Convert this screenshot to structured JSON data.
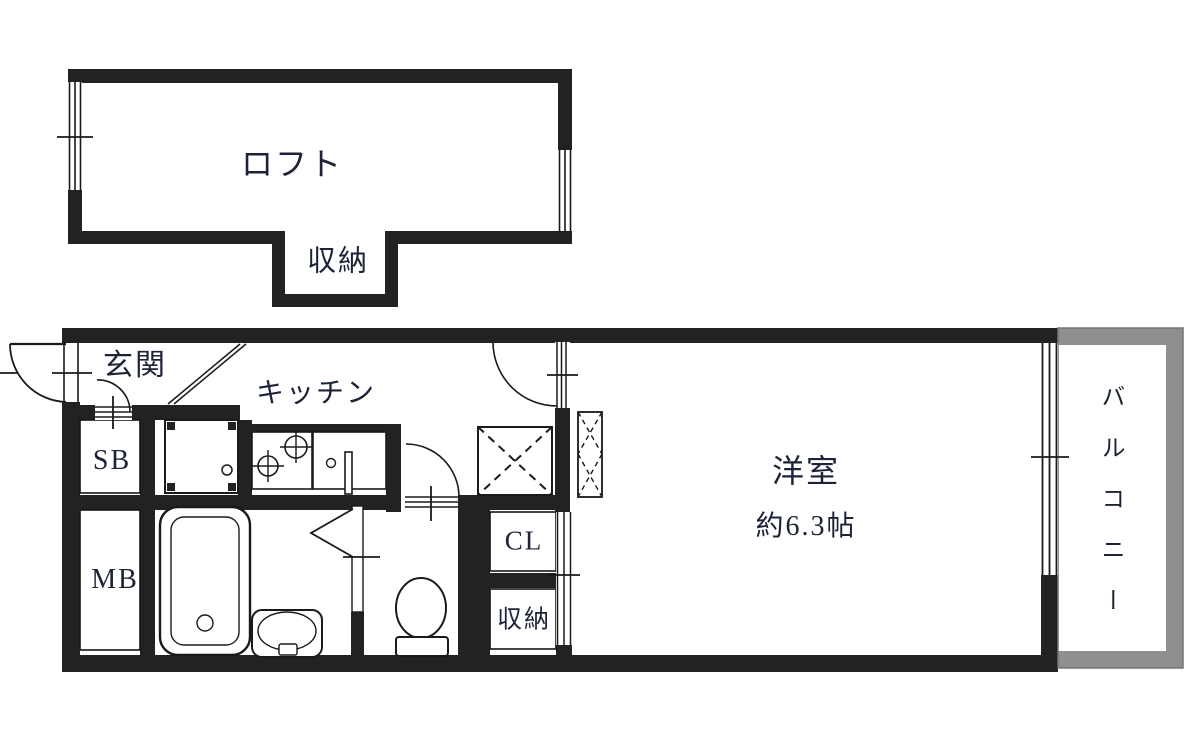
{
  "document_type": "apartment-floor-plan",
  "colors": {
    "wall": "#222222",
    "balcony_wall": "#8f8f8f",
    "balcony_outline": "#757575",
    "line": "#1a1a1a",
    "label_text": "#1d2337",
    "background": "#ffffff"
  },
  "loft": {
    "label": "ロフト",
    "storage_label": "収納"
  },
  "main_floor": {
    "entrance_label": "玄関",
    "kitchen_label": "キッチン",
    "shoe_box_label": "SB",
    "meter_box_label": "MB",
    "closet_label": "CL",
    "storage_label": "収納",
    "room_label": "洋室",
    "room_size_label": "約6.3帖",
    "balcony_label": "バルコニー"
  },
  "fixtures": [
    "entry-door",
    "shoe-box-door",
    "room-door",
    "washroom-door",
    "folding-bath-door",
    "closet-sliding-doors",
    "loft-window-left",
    "loft-window-right",
    "balcony-window",
    "washing-machine-pan",
    "stove-burners",
    "kitchen-sink",
    "bathtub",
    "vanity-sink",
    "toilet",
    "refrigerator-space",
    "loft-ladder"
  ]
}
